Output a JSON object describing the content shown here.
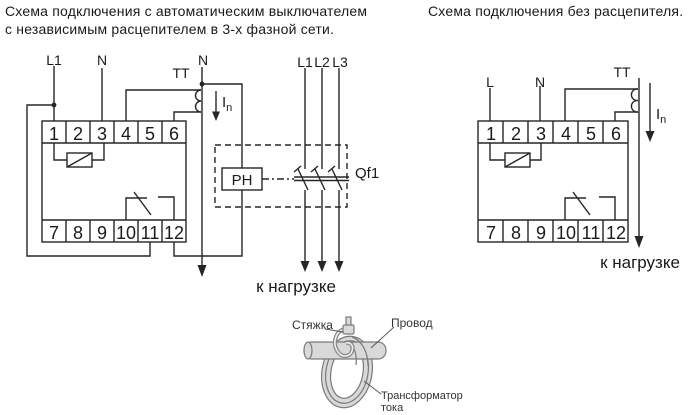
{
  "titles": {
    "left_line1": "Схема подключения с автоматическим выключателем",
    "left_line2": "с независимым расцепителем в 3-х фазной сети.",
    "right": "Схема подключения без расцепителя."
  },
  "left": {
    "l1": "L1",
    "n_in": "N",
    "tt": "TT",
    "n_load": "N",
    "in_main": "I",
    "in_sub": "n",
    "ph1": "L1",
    "ph2": "L2",
    "ph3": "L3",
    "relay": "РН",
    "breaker": "Qf1",
    "load": "к нагрузке",
    "t": [
      "1",
      "2",
      "3",
      "4",
      "5",
      "6",
      "7",
      "8",
      "9",
      "10",
      "11",
      "12"
    ]
  },
  "right": {
    "l": "L",
    "n": "N",
    "tt": "TT",
    "in_main": "I",
    "in_sub": "n",
    "load": "к нагрузке",
    "t": [
      "1",
      "2",
      "3",
      "4",
      "5",
      "6",
      "7",
      "8",
      "9",
      "10",
      "11",
      "12"
    ]
  },
  "figure": {
    "tie": "Стяжка",
    "wire": "Провод",
    "ct_line1": "Трансформатор",
    "ct_line2": "тока"
  },
  "colors": {
    "line": "#262626",
    "gray_fill": "#d9d9d9",
    "gray_stroke": "#7a7a7a"
  }
}
